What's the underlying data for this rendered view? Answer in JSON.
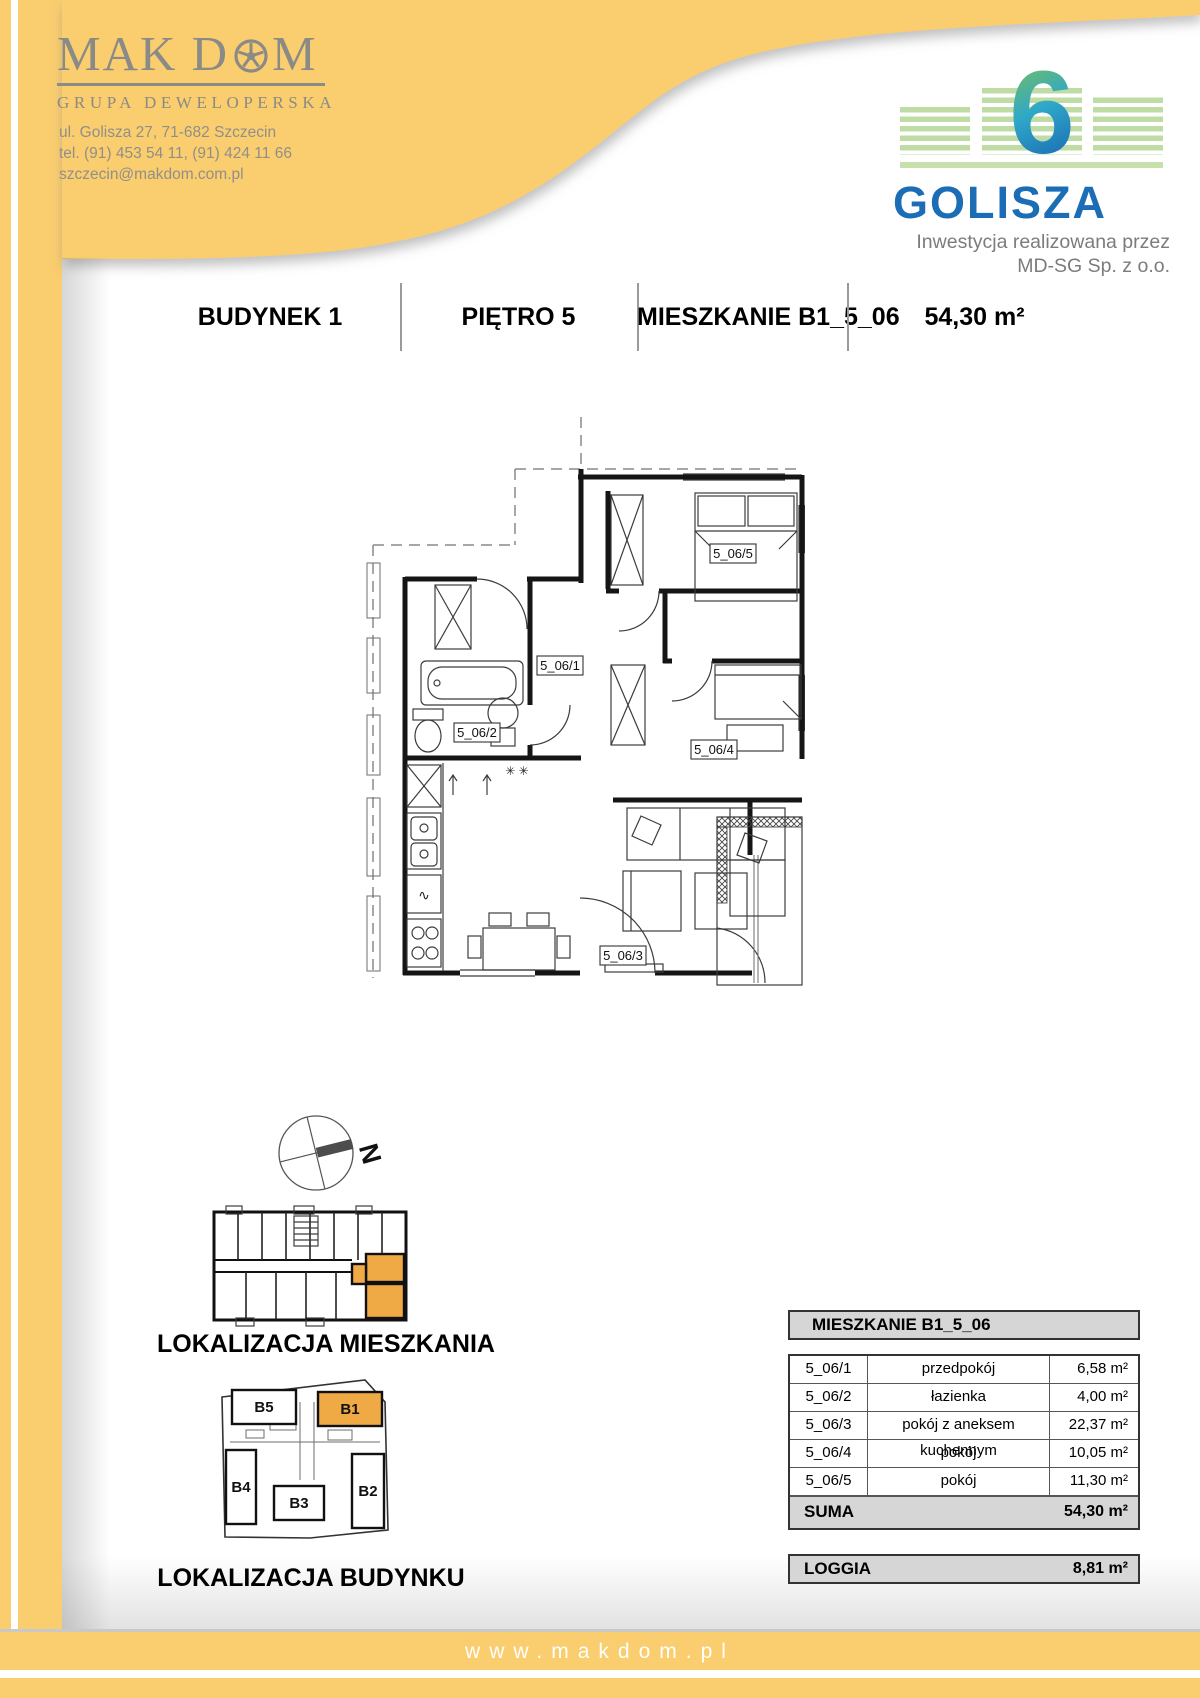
{
  "colors": {
    "yellow": "#FACD6E",
    "orange": "#EFA945",
    "blue": "#1B6DB5",
    "green_light": "#BFDCA5",
    "logo_gray": "#8a8a86"
  },
  "company": {
    "name_left": "MAK D",
    "name_right": "M",
    "wheel_icon": "wheel-o-icon",
    "tagline": "GRUPA DEWELOPERSKA",
    "address": "ul. Golisza 27, 71-682 Szczecin",
    "phone": "tel. (91) 453 54 11, (91) 424 11 66",
    "email": "szczecin@makdom.com.pl"
  },
  "project": {
    "number": "6",
    "name": "GOLISZA",
    "investor_line1": "Inwestycja realizowana przez",
    "investor_line2": "MD-SG Sp. z o.o."
  },
  "header": {
    "building": "BUDYNEK 1",
    "floor": "PIĘTRO 5",
    "apartment": "MIESZKANIE B1_5_06",
    "area": "54,30 m²"
  },
  "plan_labels": {
    "r1": "5_06/1",
    "r2": "5_06/2",
    "r3": "5_06/3",
    "r4": "5_06/4",
    "r5": "5_06/5",
    "tv": "TV",
    "stars": "✳ ✳"
  },
  "compass": {
    "north": "N"
  },
  "location": {
    "apartment_caption": "LOKALIZACJA MIESZKANIA",
    "building_caption": "LOKALIZACJA BUDYNKU",
    "buildings": {
      "b1": "B1",
      "b2": "B2",
      "b3": "B3",
      "b4": "B4",
      "b5": "B5"
    }
  },
  "table": {
    "title": "MIESZKANIE B1_5_06",
    "rows": [
      {
        "code": "5_06/1",
        "name": "przedpokój",
        "area": "6,58 m²"
      },
      {
        "code": "5_06/2",
        "name": "łazienka",
        "area": "4,00 m²"
      },
      {
        "code": "5_06/3",
        "name": "pokój z aneksem kuchennym",
        "area": "22,37 m²"
      },
      {
        "code": "5_06/4",
        "name": "pokój",
        "area": "10,05 m²"
      },
      {
        "code": "5_06/5",
        "name": "pokój",
        "area": "11,30 m²"
      }
    ],
    "suma_label": "SUMA",
    "suma_value": "54,30 m²",
    "loggia_label": "LOGGIA",
    "loggia_value": "8,81 m²"
  },
  "footer": {
    "url": "www.makdom.pl"
  }
}
